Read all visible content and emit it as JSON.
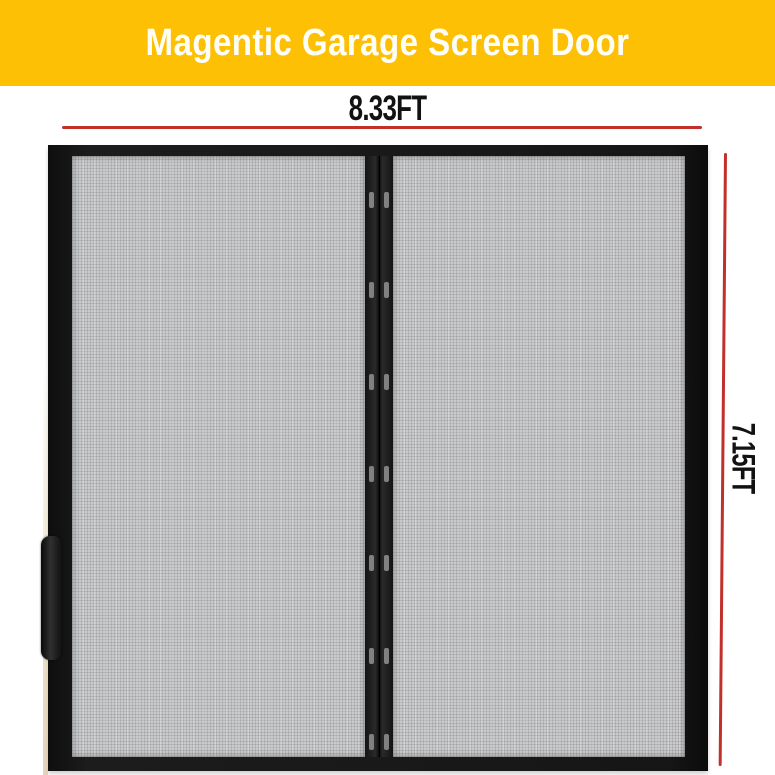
{
  "banner": {
    "title": "Magentic Garage Screen Door",
    "background_color": "#FDC005",
    "text_color": "#FFFFFF"
  },
  "dimensions": {
    "width": {
      "label": "8.33FT"
    },
    "height": {
      "label": "7.15FT"
    },
    "line_color": "#C1302B",
    "label_color": "#121212"
  },
  "door": {
    "panel_count": 2,
    "magnet_pair_count": 7,
    "frame_color": "#141414",
    "mesh_color": "#C9CACB",
    "magnet_color": "#8E8E8E"
  }
}
